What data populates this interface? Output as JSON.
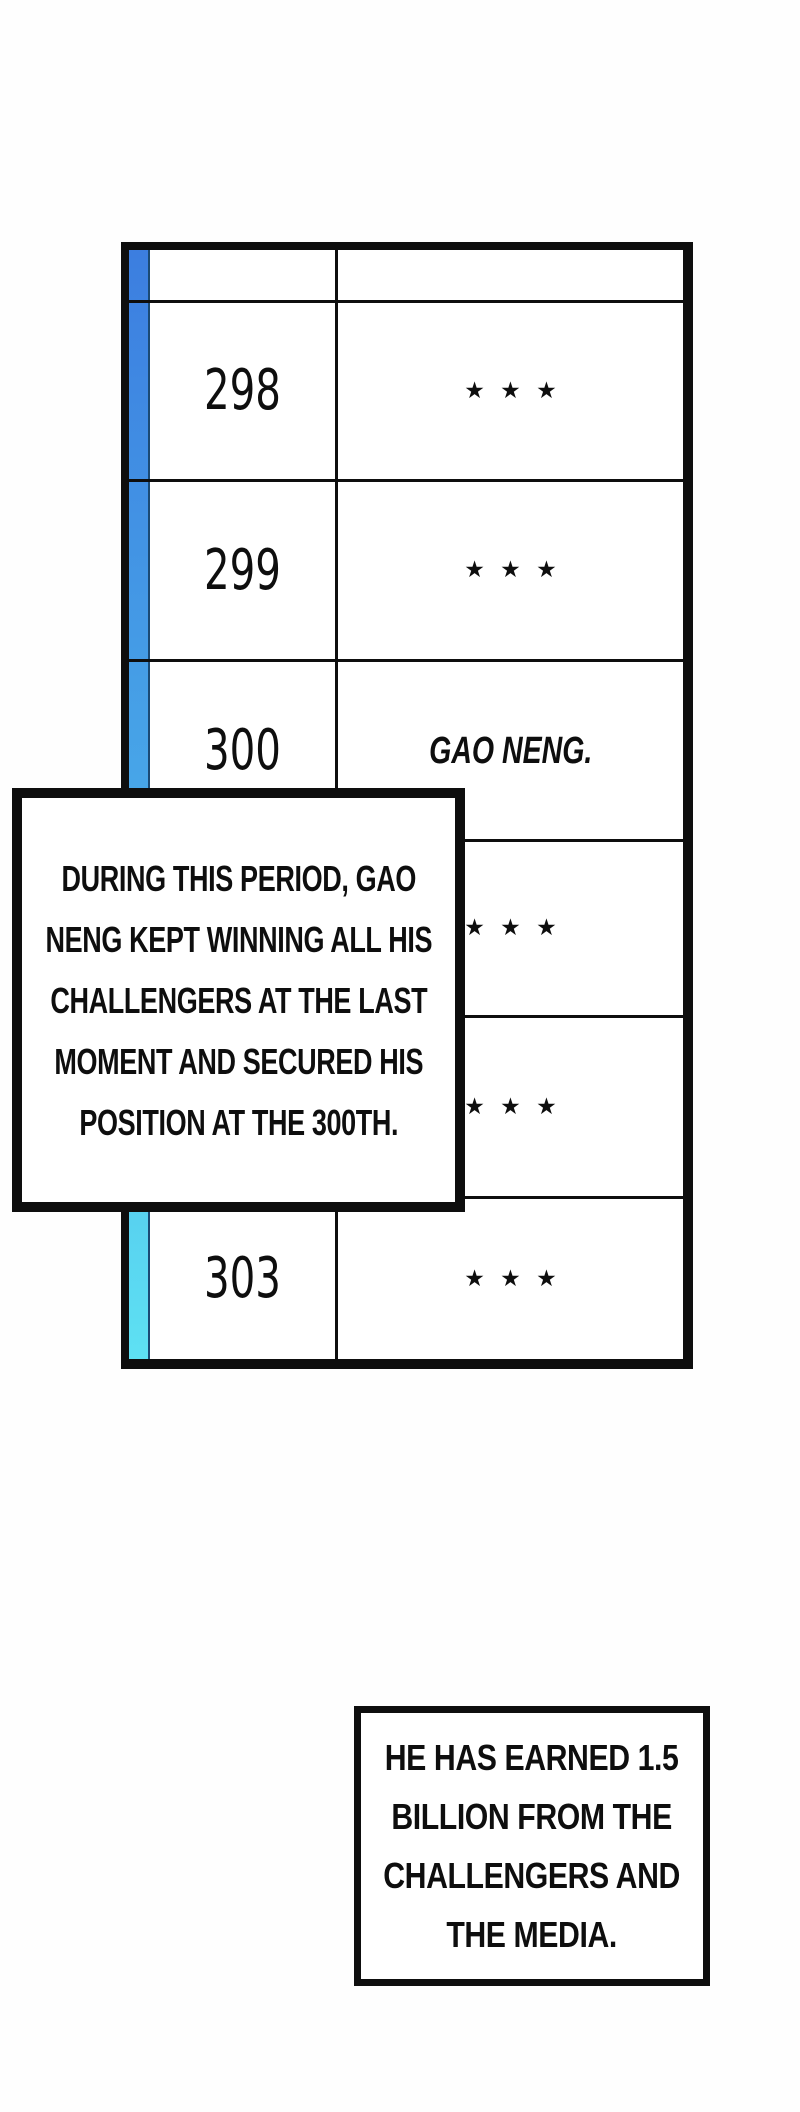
{
  "colors": {
    "ink": "#0e0e0e",
    "paper": "#fefefe",
    "strip_gradient_top": "#3c7ee0",
    "strip_gradient_middle": "#49abe9",
    "strip_gradient_bottom": "#5ee1f3",
    "strip_edge": "#1b4a74"
  },
  "ranking_table": {
    "header_rank": "",
    "header_name": "",
    "rows": [
      {
        "rank": "298",
        "name": "★ ★ ★"
      },
      {
        "rank": "299",
        "name": "★ ★ ★"
      },
      {
        "rank": "300",
        "name": "GAO NENG."
      },
      {
        "rank": "",
        "name": "★ ★ ★"
      },
      {
        "rank": "",
        "name": "★ ★ ★"
      },
      {
        "rank": "303",
        "name": "★ ★ ★"
      }
    ]
  },
  "narration": {
    "box1_lines": [
      "DURING THIS PERIOD, GAO",
      "NENG KEPT WINNING ALL HIS",
      "CHALLENGERS AT THE LAST",
      "MOMENT AND SECURED HIS",
      "POSITION AT THE 300TH."
    ],
    "box2_lines": [
      "HE HAS EARNED 1.5",
      "BILLION FROM THE",
      "CHALLENGERS AND",
      "THE MEDIA."
    ]
  }
}
